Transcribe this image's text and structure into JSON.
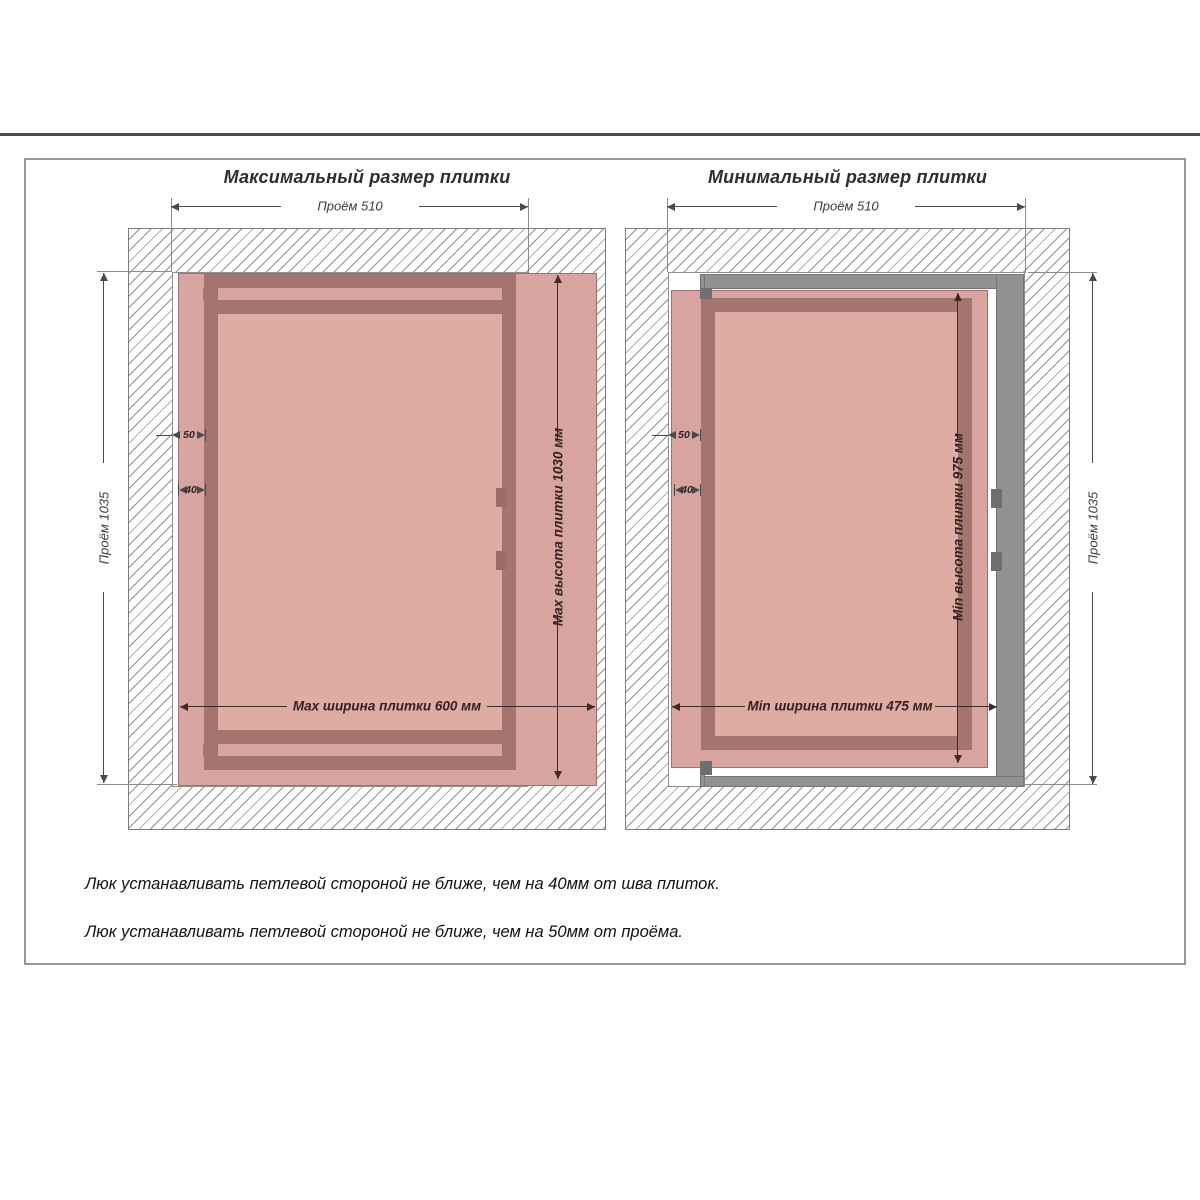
{
  "panels": [
    {
      "title": "Максимальный размер плитки",
      "dims": {
        "opening_width": "Проём 510",
        "opening_height": "Проём 1035",
        "tile_width": "Max ширина плитки 600 мм",
        "tile_height": "Max высота плитки 1030 мм",
        "hinge_to_opening": "50",
        "hinge_to_seam": "40"
      }
    },
    {
      "title": "Минимальный размер плитки",
      "dims": {
        "opening_width": "Проём 510",
        "opening_height": "Проём 1035",
        "tile_width": "Min ширина плитки 475 мм",
        "tile_height": "Min высота плитки 975 мм",
        "hinge_to_opening": "50",
        "hinge_to_seam": "40"
      }
    }
  ],
  "notes": [
    "Люк устанавливать петлевой стороной не ближе, чем на 40мм от шва плиток.",
    "Люк устанавливать петлевой стороной не ближе, чем на 50мм от проёма."
  ],
  "colors": {
    "tile_pink": "#d8a4a0",
    "tile_pink_light": "#deaca2",
    "frame_dark_pink": "#a47470",
    "frame_gray": "#919191",
    "frame_gray_dark": "#6f6f6f",
    "hatch_line": "#909090",
    "dim_line": "#4a4a4a",
    "dim_accent": "#3f2a28",
    "page_border": "#989898",
    "top_rule": "#4a4a4a"
  }
}
